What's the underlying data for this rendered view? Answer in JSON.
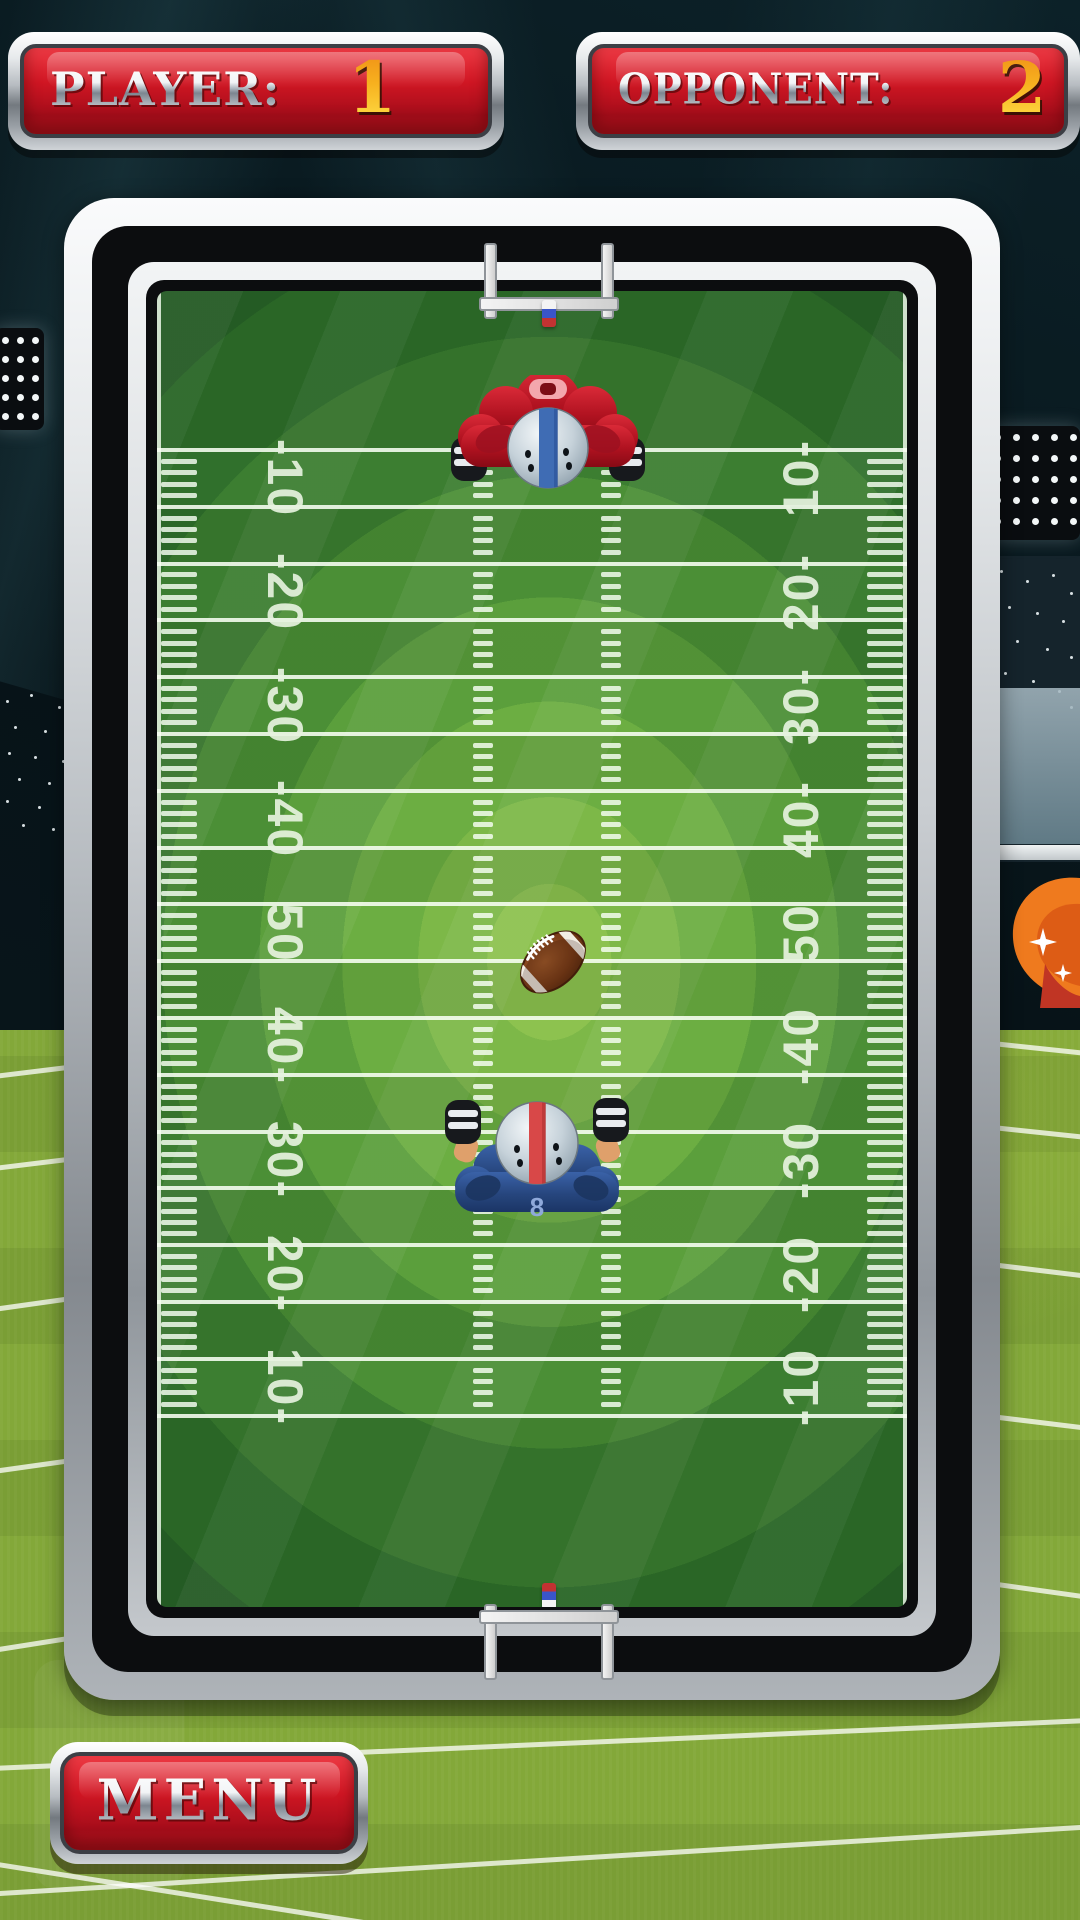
{
  "hud": {
    "player_panel": {
      "label": "PLAYER:",
      "score": "1"
    },
    "opponent_panel": {
      "label": "OPPONENT:",
      "score": "2"
    }
  },
  "controls": {
    "menu_label": "MENU"
  },
  "field": {
    "yard_numbers_left": [
      "-10",
      "-20",
      "-30",
      "-40",
      "50",
      "40-",
      "30-",
      "20-",
      "10-"
    ],
    "yard_numbers_right": [
      "10-",
      "20-",
      "30-",
      "40-",
      "50",
      "-40",
      "-30",
      "-20",
      "-10"
    ]
  },
  "game_objects": {
    "ball": {
      "type": "football"
    },
    "top_player": {
      "team_color": "red",
      "helmet_stripe": "blue"
    },
    "bottom_player": {
      "team_color": "blue",
      "helmet_stripe": "red",
      "jersey_number": "8"
    }
  },
  "colors": {
    "panel_red": "#c11420",
    "score_yellow": "#ffd535",
    "metal_light": "#f4f6f8",
    "metal_dark": "#8a9197",
    "field_green_center": "#8dc24f",
    "field_green_edge": "#2a642a",
    "grass": "#83a839",
    "team_red": "#c32330",
    "team_blue": "#2c4f8e"
  }
}
